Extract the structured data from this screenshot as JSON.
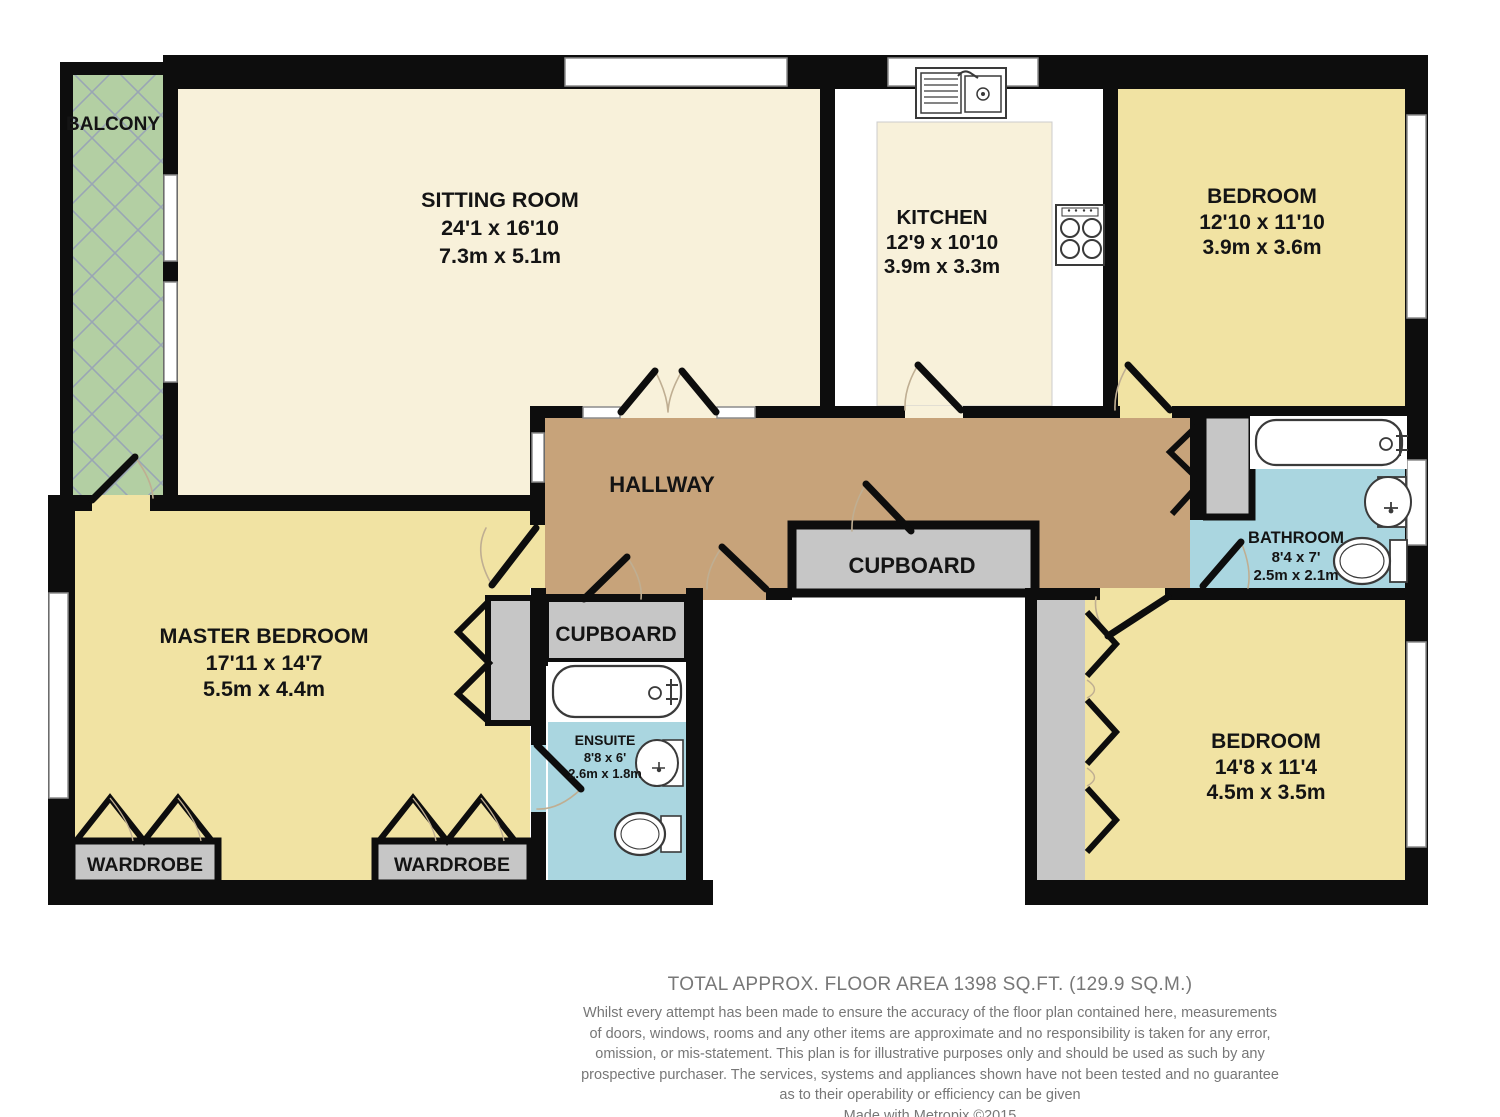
{
  "rooms": {
    "balcony": {
      "label": "BALCONY"
    },
    "sitting_room": {
      "label": "SITTING ROOM",
      "size_imperial": "24'1 x 16'10",
      "size_metric": "7.3m x 5.1m"
    },
    "kitchen": {
      "label": "KITCHEN",
      "size_imperial": "12'9 x 10'10",
      "size_metric": "3.9m x 3.3m"
    },
    "bedroom_top_right": {
      "label": "BEDROOM",
      "size_imperial": "12'10 x 11'10",
      "size_metric": "3.9m x 3.6m"
    },
    "hallway": {
      "label": "HALLWAY"
    },
    "bathroom": {
      "label": "BATHROOM",
      "size_imperial": "8'4 x 7'",
      "size_metric": "2.5m x 2.1m"
    },
    "hall_cupboard": {
      "label": "CUPBOARD"
    },
    "inner_cupboard": {
      "label": "CUPBOARD"
    },
    "master_bedroom": {
      "label": "MASTER BEDROOM",
      "size_imperial": "17'11 x 14'7",
      "size_metric": "5.5m x 4.4m"
    },
    "ensuite": {
      "label": "ENSUITE",
      "size_imperial": "8'8 x 6'",
      "size_metric": "2.6m x 1.8m"
    },
    "wardrobe_left": {
      "label": "WARDROBE"
    },
    "wardrobe_right": {
      "label": "WARDROBE"
    },
    "bedroom_bottom_right": {
      "label": "BEDROOM",
      "size_imperial": "14'8 x 11'4",
      "size_metric": "4.5m x 3.5m"
    }
  },
  "footer": {
    "total_area": "TOTAL APPROX. FLOOR AREA 1398 SQ.FT. (129.9 SQ.M.)",
    "disclaimer_lines": [
      "Whilst every attempt has been made to ensure the accuracy of the floor plan contained here, measurements",
      "of doors, windows, rooms and any other items are approximate and no responsibility is taken for any error,",
      "omission, or mis-statement. This plan is for illustrative purposes only and should be used as such by any",
      "prospective purchaser. The services, systems and appliances shown have not been tested and no guarantee",
      "as to their operability or efficiency can be given"
    ],
    "credit": "Made with Metropix ©2015"
  },
  "colors": {
    "wall": "#0d0d0d",
    "sitting_cream": "#f8f1da",
    "bedroom_yellow": "#f1e3a3",
    "hallway_brown": "#c7a37a",
    "cupboard_gray": "#c6c6c6",
    "bathroom_blue": "#aad6e0",
    "balcony_green": "#b3cfa3",
    "balcony_hatch": "#9aa6b4",
    "footer_text": "#777777"
  }
}
